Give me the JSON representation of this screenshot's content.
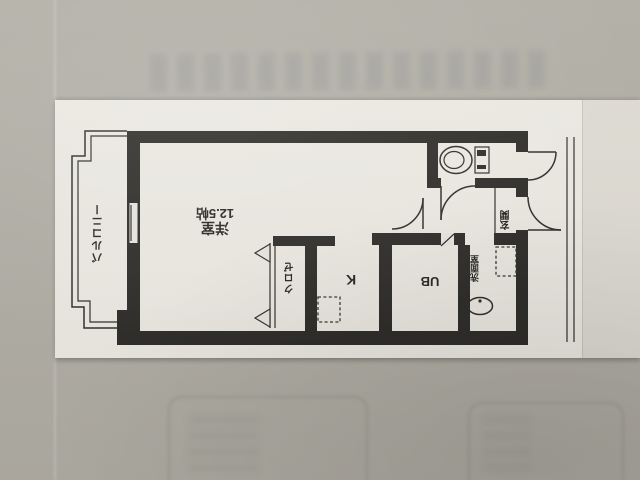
{
  "colors": {
    "photo_background": "#b0ada4",
    "paper": "#ece9e2",
    "paper_right_fold": "#dedbd3",
    "ink": "#292824"
  },
  "floorplan": {
    "orientation": "printed upside-down (rotated 180°) in photo",
    "labels": {
      "main_room_name": "洋室",
      "main_room_size": "12.5帖",
      "balcony": "バルコニー",
      "closet": "クロゼ",
      "kitchen": "K",
      "unit_bath": "UB",
      "washroom": "洗面室",
      "entrance": "玄関"
    }
  }
}
